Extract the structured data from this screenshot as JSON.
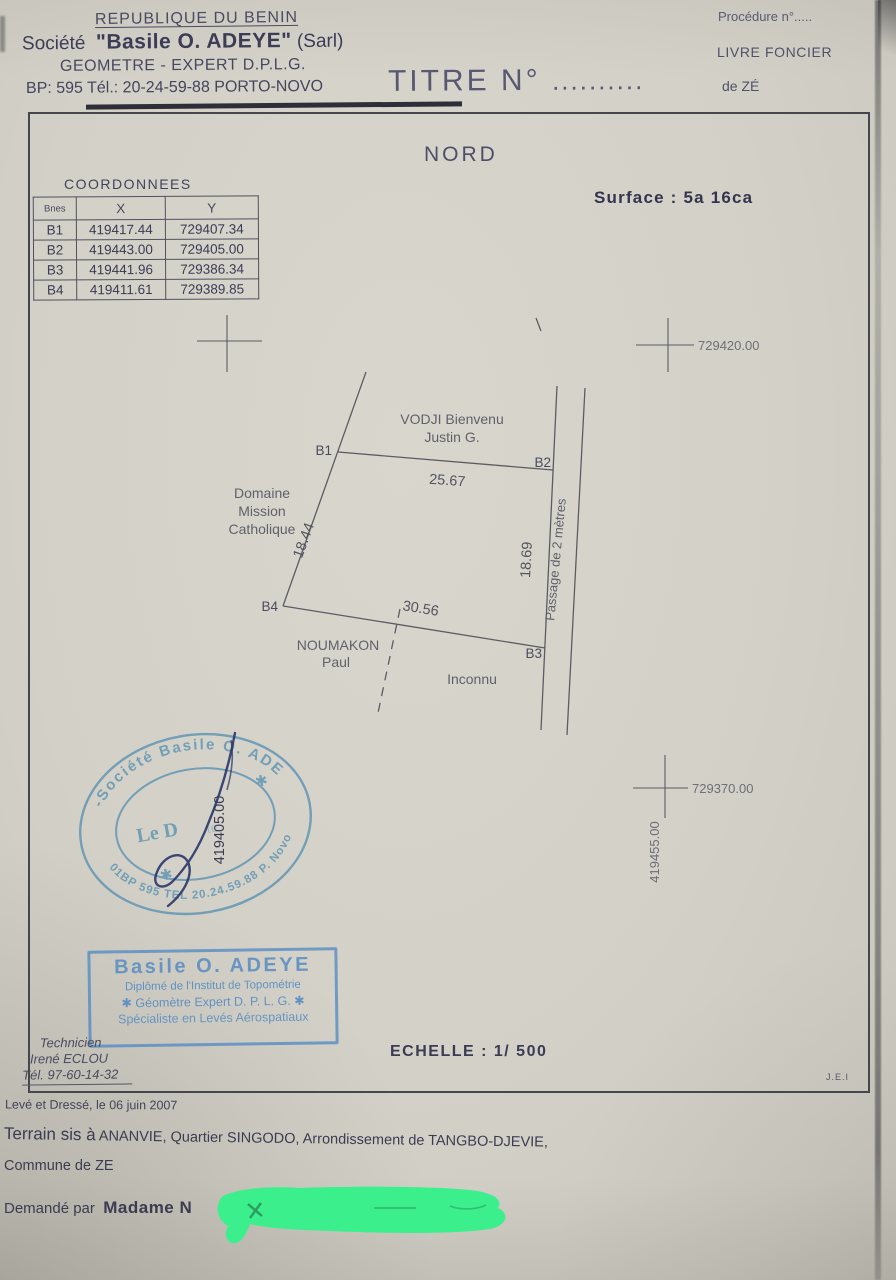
{
  "header": {
    "republic": "REPUBLIQUE DU BENIN",
    "societe_prefix": "Société",
    "societe_name": "\"Basile O. ADEYE\"",
    "societe_suffix": "(Sarl)",
    "profession": "GEOMETRE - EXPERT D.P.L.G.",
    "address": "BP: 595 Tél.: 20-24-59-88 PORTO-NOVO",
    "titre": "TITRE N°",
    "titre_dots": "..........",
    "procedure": "Procédure n°.....",
    "livre_foncier": "LIVRE FONCIER",
    "de_ze": "de ZÉ"
  },
  "plan": {
    "north": "NORD",
    "surface": "Surface :  5a 16ca",
    "coordinates": {
      "title": "COORDONNEES",
      "columns": [
        "Bnes",
        "X",
        "Y"
      ],
      "rows": [
        [
          "B1",
          "419417.44",
          "729407.34"
        ],
        [
          "B2",
          "419443.00",
          "729405.00"
        ],
        [
          "B3",
          "419441.96",
          "729386.34"
        ],
        [
          "B4",
          "419411.61",
          "729389.85"
        ]
      ]
    },
    "grid_labels": {
      "y_top": "729420.00",
      "y_bottom": "729370.00",
      "x_left": "419405.00",
      "x_right": "419455.00"
    },
    "parcel": {
      "corner_b1": "B1",
      "corner_b2": "B2",
      "corner_b3": "B3",
      "corner_b4": "B4",
      "side_top": "25.67",
      "side_right": "18.69",
      "side_bottom": "30.56",
      "side_left": "18.44",
      "neighbor_north_1": "VODJI Bienvenu",
      "neighbor_north_2": "Justin G.",
      "neighbor_west_1": "Domaine",
      "neighbor_west_2": "Mission",
      "neighbor_west_3": "Catholique",
      "neighbor_south_1": "NOUMAKON",
      "neighbor_south_2": "Paul",
      "neighbor_southeast": "Inconnu",
      "easement_east": "Passage de  2 mètres"
    },
    "scale": "ECHELLE : 1/ 500",
    "initials": "J.E.I"
  },
  "round_stamp": {
    "arc_top": "-Société Basile O. ADE",
    "arc_bottom": "01BP 595 TEL 20.24.59.88 P. Novo",
    "center_text": "Le D",
    "center_text_faint": "te",
    "asterisk": "✱"
  },
  "rect_stamp": {
    "name": "Basile O. ADEYE",
    "line2": "Diplômé de l'Institut de Topométrie",
    "line3": "✱  Géomètre Expert D. P. L. G.  ✱",
    "line4": "Spécialiste en Levés Aérospatiaux"
  },
  "technician": {
    "role": "Technicien",
    "name": "Irené ECLOU",
    "phone": "Tél. 97-60-14-32"
  },
  "footer": {
    "surveyed": "Levé et Dressé, le  06 juin 2007",
    "terrain_prefix": "Terrain sis à",
    "terrain_rest": " ANANVIE, Quartier SINGODO, Arrondissement de TANGBO-DJEVIE,",
    "commune": "Commune de ZE",
    "requested_prefix": "Demandé par",
    "requested_name": "Madame N"
  },
  "colors": {
    "ink": "#3e3e56",
    "pencil": "#5b5b66",
    "seal_teal": "#5d93b3",
    "stamp_blue": "#4e87c2",
    "signature_ink": "#2e3a6b",
    "redaction_green": "#3bef8d"
  }
}
